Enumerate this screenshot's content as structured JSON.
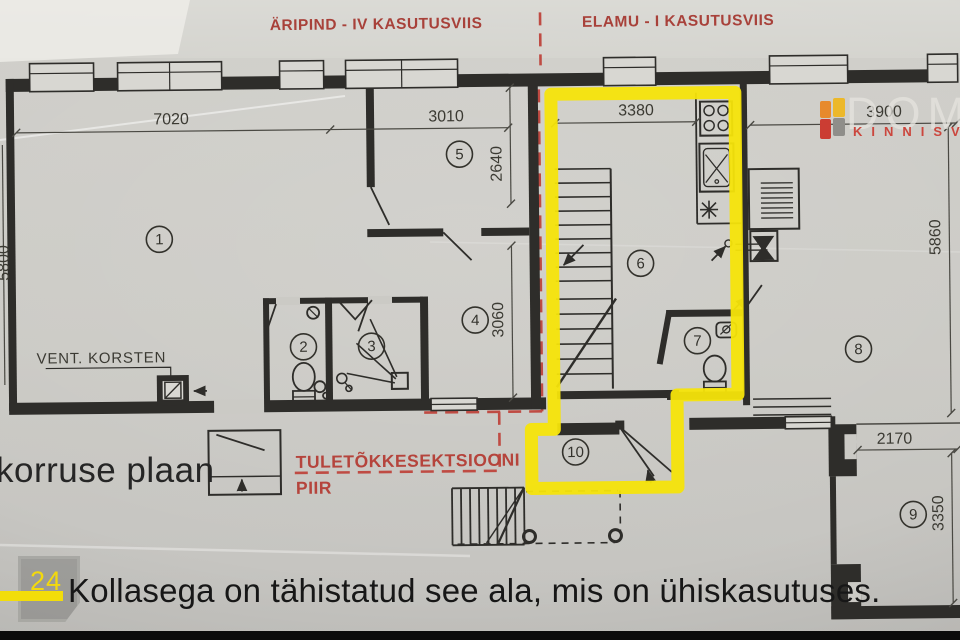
{
  "section_labels": {
    "left": "ÄRIPIND - IV KASUTUSVIIS",
    "right": "ELAMU - I KASUTUSVIIS"
  },
  "floor_plan": {
    "room_numbers": [
      "1",
      "2",
      "3",
      "4",
      "5",
      "6",
      "7",
      "8",
      "9",
      "10"
    ],
    "dimensions": {
      "room1_width": "7020",
      "room5_width": "3010",
      "room6_width": "3380",
      "room8_width": "3900",
      "left_height": "5800",
      "room5_height": "2640",
      "room4_height": "3060",
      "room8_height": "5860",
      "room9_width": "2170",
      "room9_height": "3350"
    },
    "annotations": {
      "vent_chimney": "VENT. KORSTEN",
      "fire_section_line1": "TULETÕKKESEKTSIOONI",
      "fire_section_line2": "PIIR"
    }
  },
  "watermark": {
    "brand": "DOMU",
    "subtitle": "KINNISVA"
  },
  "overlay": {
    "floor_label": "korruse plaan",
    "page_number": "24",
    "caption": "Kollasega on tähistatud see ala, mis on ühiskasutuses."
  },
  "colors": {
    "highlight": "#f6e40a",
    "fire_red": "#b5443c",
    "paper": "#cbcac6",
    "ink": "#2e2d2a"
  }
}
